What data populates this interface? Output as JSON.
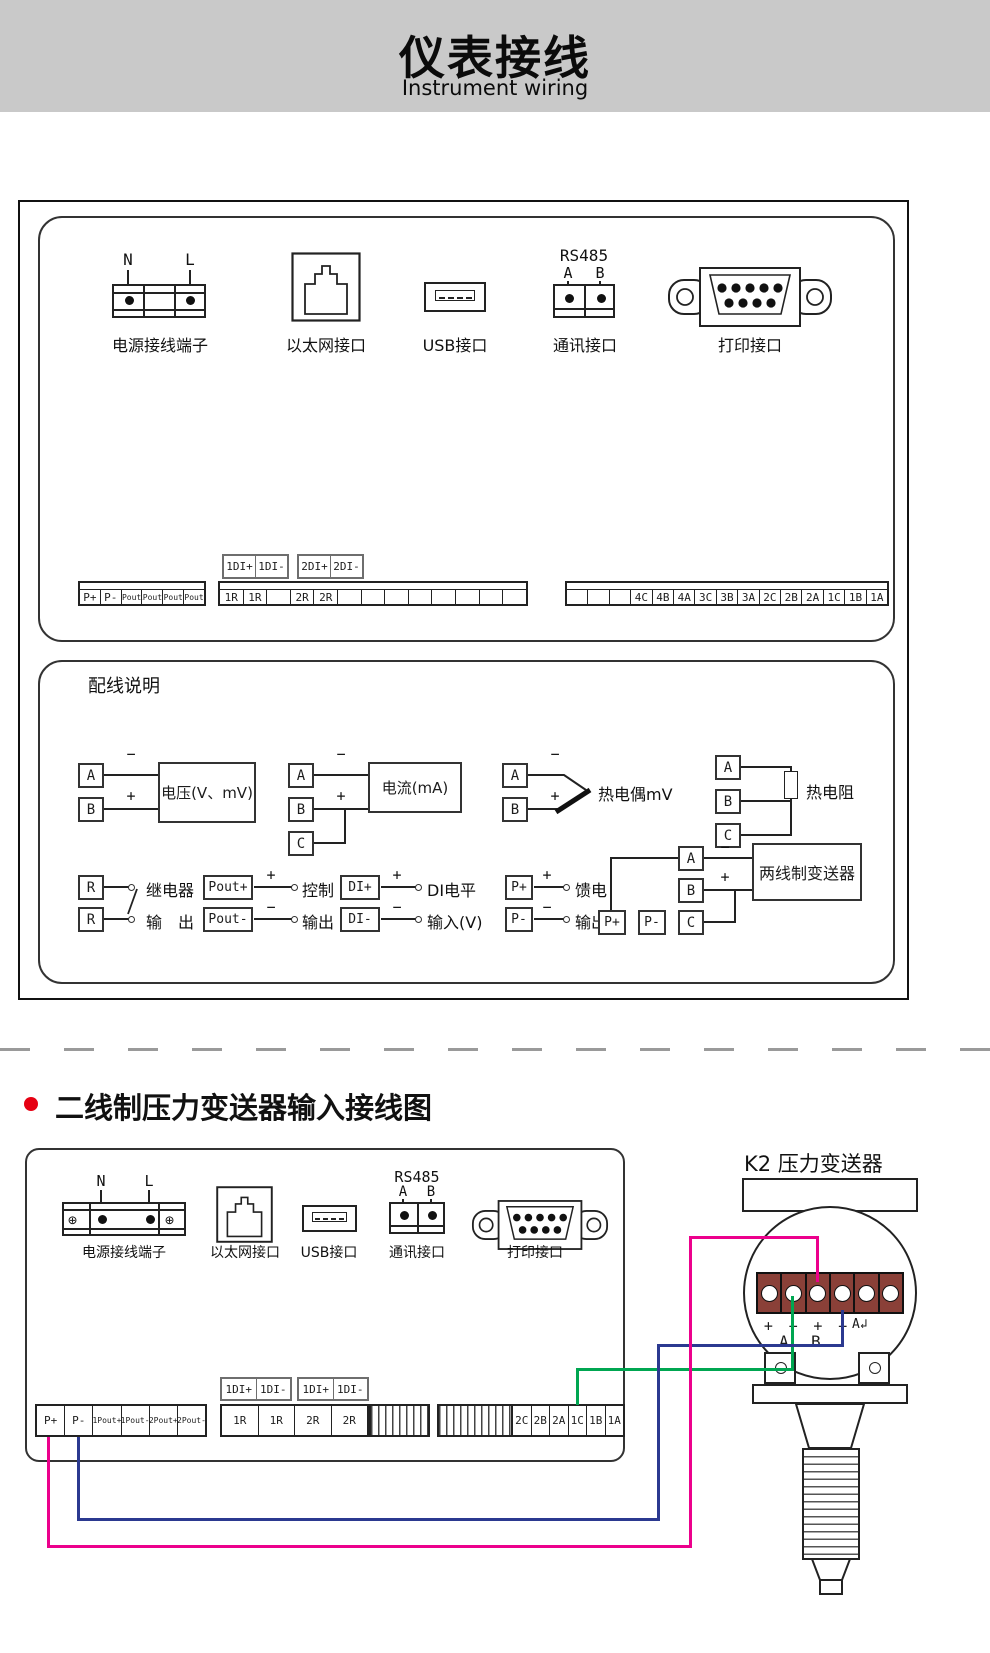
{
  "header": {
    "title": "仪表接线",
    "subtitle": "Instrument wiring"
  },
  "colors": {
    "banner": "#c9c9c9",
    "wire_green": "#00A651",
    "wire_pink": "#EC008C",
    "wire_blue": "#2B3990",
    "bullet_red": "#E60012",
    "terminal_red": "#8a4038"
  },
  "rear_panel": {
    "power": {
      "pin_n": "N",
      "pin_l": "L",
      "label": "电源接线端子"
    },
    "ethernet": {
      "label": "以太网接口"
    },
    "usb": {
      "label": "USB接口"
    },
    "comm": {
      "title": "RS485",
      "pin_a": "A",
      "pin_b": "B",
      "label": "通讯接口"
    },
    "printer": {
      "label": "打印接口"
    },
    "di_group1": [
      "1DI+",
      "1DI-"
    ],
    "di_group2": [
      "2DI+",
      "2DI-"
    ],
    "left_row": [
      "P+",
      "P-",
      "1Pout+",
      "1Pout-",
      "2Pout+",
      "2Pout-"
    ],
    "middle_row": [
      "1R",
      "1R",
      "",
      "2R",
      "2R",
      "",
      "",
      "",
      "",
      "",
      "",
      "",
      ""
    ],
    "right_row": [
      "",
      "",
      "",
      "4C",
      "4B",
      "4A",
      "3C",
      "3B",
      "3A",
      "2C",
      "2B",
      "2A",
      "1C",
      "1B",
      "1A"
    ]
  },
  "wiring_guide": {
    "title": "配线说明",
    "voltage": {
      "a": "A",
      "b": "B",
      "minus": "−",
      "plus": "+",
      "device": "电压(V、mV)"
    },
    "current": {
      "a": "A",
      "b": "B",
      "c": "C",
      "minus": "−",
      "plus": "+",
      "device": "电流(mA)"
    },
    "thermocouple": {
      "a": "A",
      "b": "B",
      "minus": "−",
      "plus": "+",
      "device": "热电偶mV"
    },
    "rtd": {
      "a": "A",
      "b": "B",
      "c": "C",
      "device": "热电阻"
    },
    "relay": {
      "t1": "R",
      "t2": "R",
      "label1": "继电器",
      "label2": "输　出"
    },
    "control": {
      "t1": "Pout+",
      "t2": "Pout-",
      "plus": "+",
      "minus": "−",
      "label1": "控制",
      "label2": "输出"
    },
    "di": {
      "t1": "DI+",
      "t2": "DI-",
      "plus": "+",
      "minus": "−",
      "label1": "DI电平",
      "label2": "输入(V)"
    },
    "feed": {
      "t1": "P+",
      "t2": "P-",
      "plus": "+",
      "minus": "−",
      "label1": "馈电",
      "label2": "输出"
    },
    "transmitter2w": {
      "p1": "P+",
      "p2": "P-",
      "a": "A",
      "b": "B",
      "c": "C",
      "minus": "−",
      "plus": "+",
      "device": "两线制变送器"
    }
  },
  "section2": {
    "title": "二线制压力变送器输入接线图",
    "k2_label": "K2 压力变送器",
    "power": {
      "pin_n": "N",
      "pin_l": "L",
      "label": "电源接线端子",
      "screw": "⊕"
    },
    "ethernet": {
      "label": "以太网接口"
    },
    "usb": {
      "label": "USB接口"
    },
    "comm": {
      "title": "RS485",
      "pin_a": "A",
      "pin_b": "B",
      "label": "通讯接口"
    },
    "printer": {
      "label": "打印接口"
    },
    "di_group1": [
      "1DI+",
      "1DI-"
    ],
    "di_group2": [
      "1DI+",
      "1DI-"
    ],
    "left_row": [
      "P+",
      "P-",
      "1Pout+",
      "1Pout-",
      "2Pout+",
      "2Pout-"
    ],
    "middle_row": [
      "1R",
      "1R",
      "2R",
      "2R"
    ],
    "right_row": [
      "2C",
      "2B",
      "2A",
      "1C",
      "1B",
      "1A"
    ],
    "transmitter": {
      "signs": [
        "+",
        "−",
        "+",
        "−"
      ],
      "a_return": "A↲",
      "term_a": "A",
      "term_b": "B"
    }
  }
}
